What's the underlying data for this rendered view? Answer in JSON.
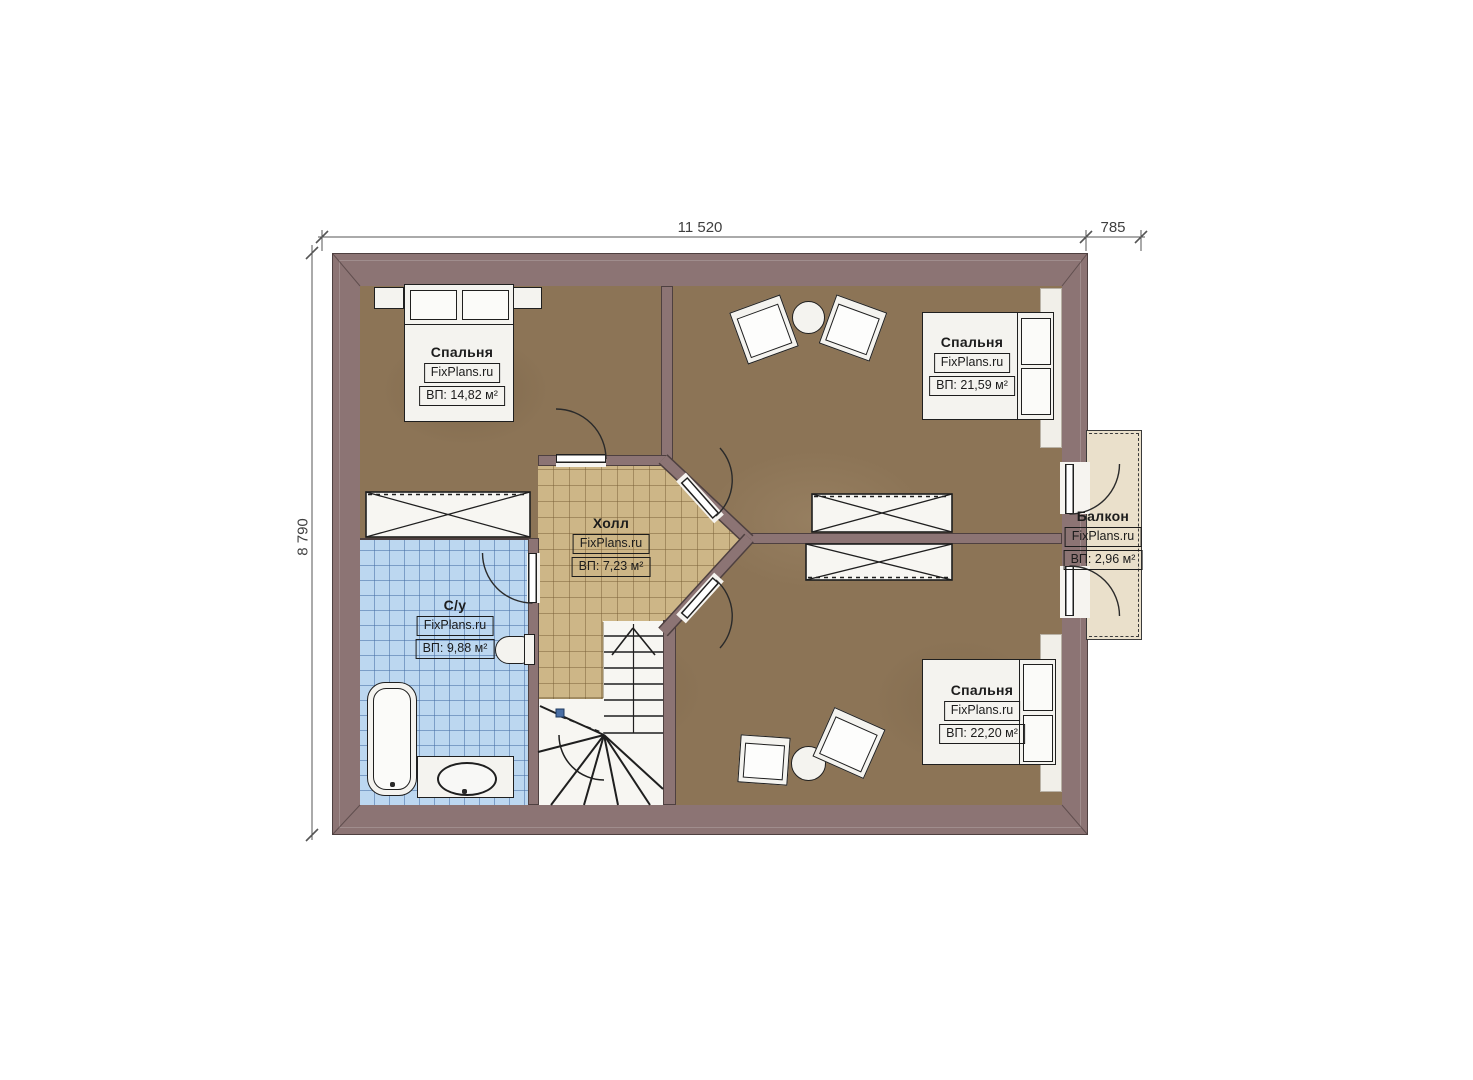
{
  "dims": {
    "width_main": "11 520",
    "width_balcony": "785",
    "height": "8 790"
  },
  "rooms": {
    "bedroom_tl": {
      "name": "Спальня",
      "brand": "FixPlans.ru",
      "area": "ВП: 14,82 м²"
    },
    "bedroom_tr": {
      "name": "Спальня",
      "brand": "FixPlans.ru",
      "area": "ВП: 21,59 м²"
    },
    "hall": {
      "name": "Холл",
      "brand": "FixPlans.ru",
      "area": "ВП: 7,23 м²"
    },
    "bathroom": {
      "name": "С/у",
      "brand": "FixPlans.ru",
      "area": "ВП: 9,88 м²"
    },
    "bedroom_br": {
      "name": "Спальня",
      "brand": "FixPlans.ru",
      "area": "ВП: 22,20 м²"
    },
    "balcony": {
      "name": "Балкон",
      "brand": "FixPlans.ru",
      "area": "ВП: 2,96 м²"
    }
  },
  "colors": {
    "wall": "#8c7474",
    "wall_edge": "#4e4040",
    "wood": "#8c7456",
    "hall": "#cdb687",
    "bath": "#bcd7f0",
    "balcony": "#eae0cb"
  }
}
